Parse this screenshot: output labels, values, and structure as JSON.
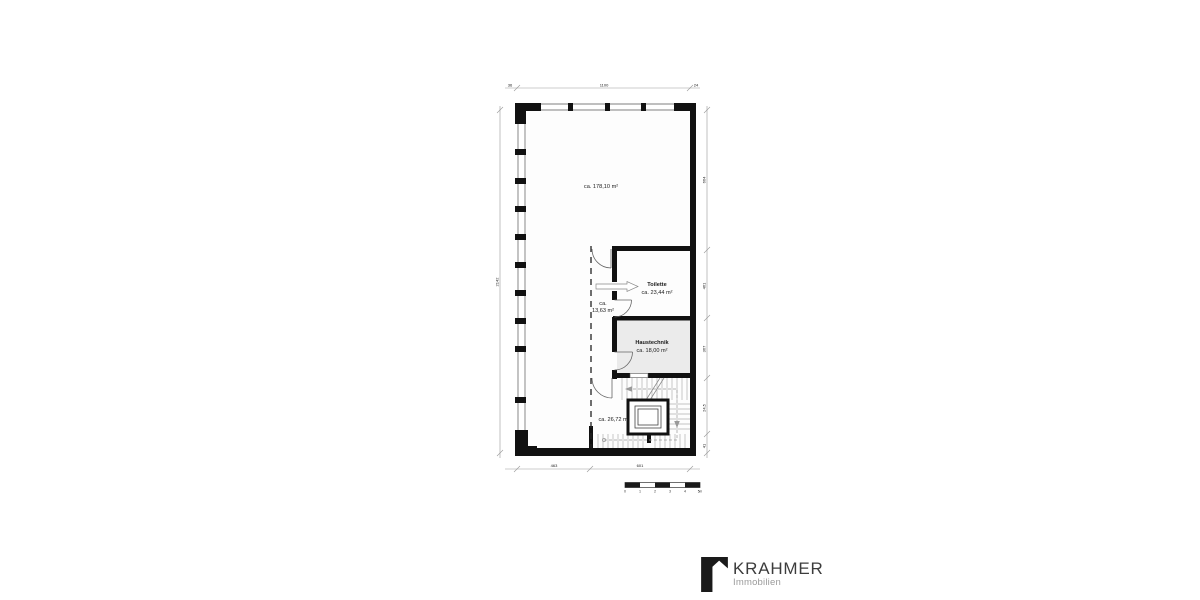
{
  "rooms": {
    "main": {
      "area": "ca. 178,10 m²"
    },
    "toilette": {
      "name": "Toilette",
      "area": "ca. 23,44 m²"
    },
    "corridor": {
      "line1": "ca.",
      "line2": "13,63 m²"
    },
    "haustechnik": {
      "name": "Haustechnik",
      "area": "ca. 18,00 m²"
    },
    "stairwell": {
      "area": "ca. 26,72 m²"
    }
  },
  "dimensions": {
    "top": {
      "left": "36",
      "middle": "1100",
      "right": "24"
    },
    "bottom": {
      "segment1": "463",
      "segment2": "601"
    },
    "left": {
      "total": "2142"
    },
    "right": {
      "segments": [
        "664",
        "461",
        "367",
        "24,5",
        "41"
      ]
    }
  },
  "scale_bar": {
    "labels": [
      "0",
      "1",
      "2",
      "3",
      "4",
      "5m"
    ]
  },
  "branding": {
    "company": "KRAHMER",
    "tagline": "Immobilien",
    "logo_icon": "building-icon"
  },
  "colors": {
    "wall": "#111111",
    "technik_fill": "#ebebeb",
    "tread_line": "#b0b0b0",
    "dim_line": "#999999",
    "logo_text": "#3c3c3c",
    "logo_sub": "#9b9b9b"
  }
}
